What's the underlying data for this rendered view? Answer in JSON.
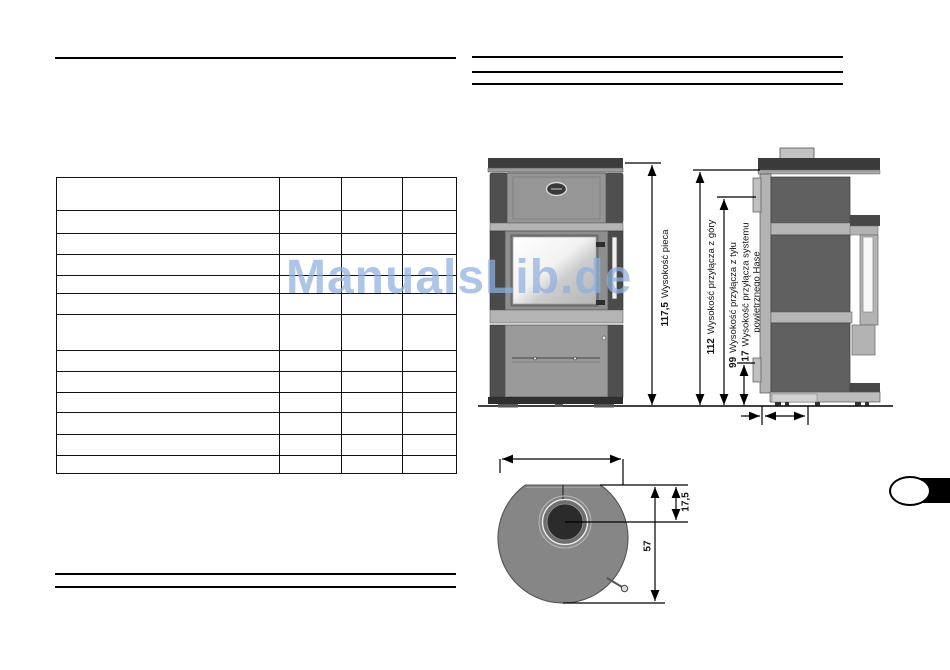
{
  "document": {
    "watermark_text": "ManualsLib.de",
    "watermark_color": "#8fb0e0"
  },
  "spec_table": {
    "row_count": 13,
    "column_count": 4
  },
  "dims": {
    "front": [
      {
        "value": "117,5",
        "label": "Wysokość pieca"
      },
      {
        "value": "112",
        "label": "Wysokość przyłącza z góry"
      },
      {
        "value": "99",
        "label": "Wysokość przyłącza z tyłu"
      },
      {
        "value": "17",
        "label": "Wysokość przyłącza systemu powietrznego Hase"
      }
    ],
    "top_view": [
      {
        "value": "17,5"
      },
      {
        "value": "57"
      }
    ]
  }
}
